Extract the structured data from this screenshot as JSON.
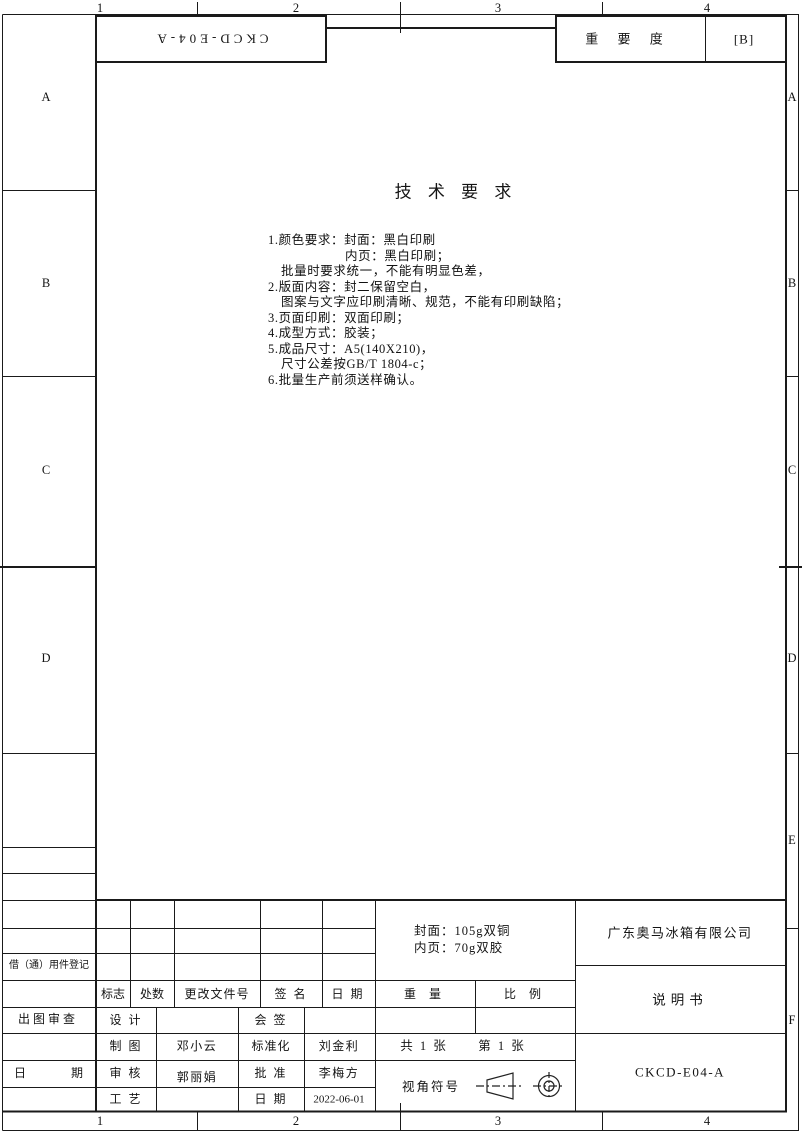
{
  "colors": {
    "line": "#1a1a1a",
    "text": "#141414"
  },
  "zones": {
    "top": [
      "1",
      "2",
      "3",
      "4"
    ],
    "bottom": [
      "1",
      "2",
      "3",
      "4"
    ],
    "left": [
      "A",
      "B",
      "C",
      "D"
    ],
    "right": [
      "A",
      "B",
      "C",
      "D",
      "E",
      "F"
    ]
  },
  "header": {
    "drawing_code_rotated": "CKCD-E04-A",
    "importance_label": "重 要 度",
    "importance_value": "[B]"
  },
  "tech": {
    "title": "技 术 要 求",
    "lines": [
      "1.颜色要求：封面：黑白印刷",
      "内页：黑白印刷；",
      "批量时要求统一，不能有明显色差，",
      "2.版面内容：封二保留空白，",
      "图案与文字应印刷清晰、规范，不能有印刷缺陷；",
      "3.页面印刷：双面印刷；",
      "4.成型方式：胶装；",
      "5.成品尺寸：A5(140X210)，",
      "尺寸公差按GB/T 1804-c；",
      "6.批量生产前须送样确认。"
    ]
  },
  "left_table": {
    "borrow_label": "借（通）用件登记",
    "review_label": "出图审查",
    "date_left": "日",
    "date_right": "期"
  },
  "title_block": {
    "rev_mark": "标志",
    "rev_qty": "处数",
    "rev_doc": "更改文件号",
    "rev_sign": "签 名",
    "rev_date": "日 期",
    "weight_label": "重 量",
    "scale_label": "比 例",
    "paper_line1": "封面：105g双铜",
    "paper_line2": "内页：70g双胶",
    "design_label": "设 计",
    "countersign_label": "会 签",
    "draft_label": "制 图",
    "draft_name": "邓小云",
    "std_label": "标准化",
    "std_name": "刘金利",
    "check_label": "审 核",
    "check_name": "郭丽娟",
    "approve_label": "批 准",
    "approve_name": "李梅方",
    "craft_label": "工 艺",
    "date_label": "日 期",
    "date_value": "2022-06-01",
    "sheets_total": "共 1 张",
    "sheets_no": "第 1 张",
    "view_label": "视角符号",
    "company": "广东奥马冰箱有限公司",
    "doc_name": "说明书",
    "drawing_no": "CKCD-E04-A"
  }
}
